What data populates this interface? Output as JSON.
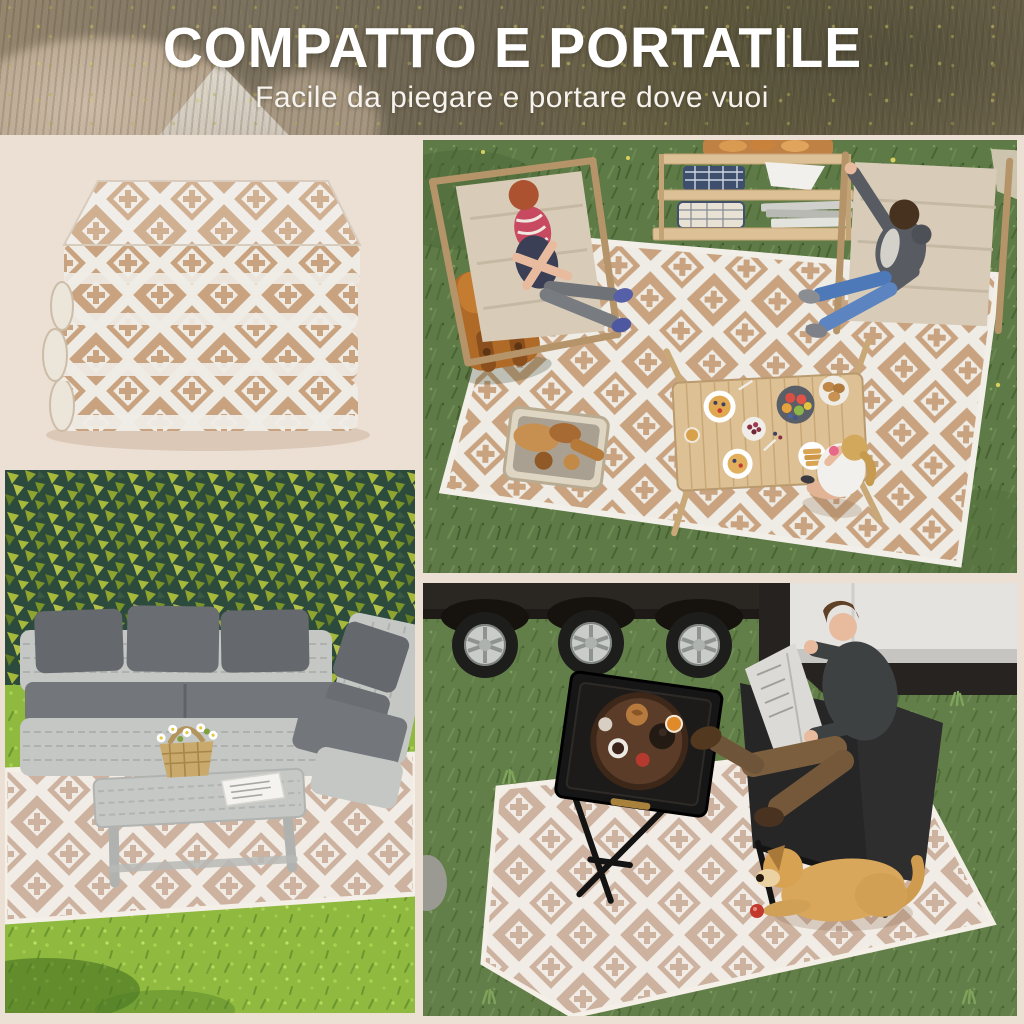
{
  "header": {
    "title": "COMPATTO E PORTATILE",
    "subtitle": "Facile da piegare e portare dove vuoi"
  },
  "panels": {
    "product": {
      "label": "tappeto pieghevole piegato"
    },
    "picnic": {
      "label": "picnic sul prato con tappeto a rombi"
    },
    "patio": {
      "label": "salotto da giardino in rattan con tappeto"
    },
    "camping": {
      "label": "relax accanto al camper con cane sul tappeto"
    }
  },
  "palette": {
    "page_bg": "#ecdfd3",
    "title_color": "#ffffff",
    "rug_tan": "#c9a37f",
    "rug_white": "#efece6",
    "rug_pale": "#cdb2a0",
    "rug_pale_white": "#f1ece5",
    "grass_dark": "#5e7a46",
    "grass_bright": "#8fb93f",
    "ivy_base": "#2d4b3c",
    "ivy_leaf": "#a7b93a",
    "wood": "#dcc096",
    "canvas": "#d8ccb8",
    "sofa_frame": "#c4c7c4",
    "sofa_cushion": "#6e7174",
    "trailer_dark": "#2a2622",
    "trailer_white": "#e4e3df",
    "backpack": "#b06a28",
    "dog": "#d9a75b",
    "denim": "#4e79b8",
    "skin": "#e8bb9e"
  }
}
